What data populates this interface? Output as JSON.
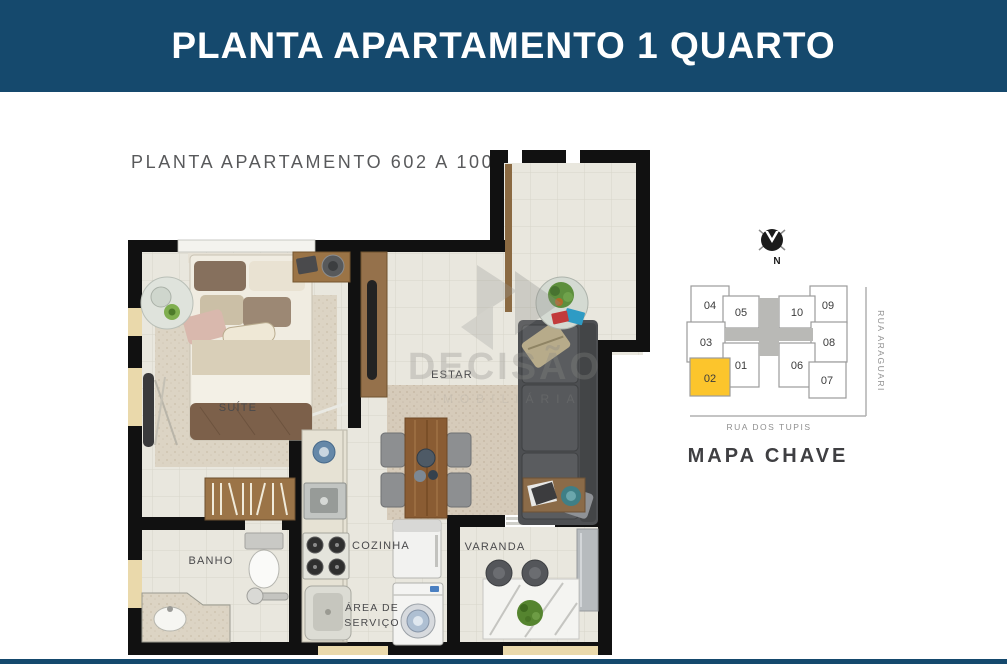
{
  "header": {
    "title": "PLANTA APARTAMENTO 1 QUARTO",
    "bg_color": "#15496d"
  },
  "plan": {
    "title": "PLANTA APARTAMENTO 602 A 1002",
    "rooms": {
      "suite": "SUÍTE",
      "estar": "ESTAR",
      "banho": "BANHO",
      "cozinha": "COZINHA",
      "area_servico_line1": "ÁREA DE",
      "area_servico_line2": "SERVIÇO",
      "varanda": "VARANDA"
    },
    "watermark": {
      "name": "DECISÃO",
      "subtitle": "IMOBILIÁRIA"
    }
  },
  "key_map": {
    "title": "MAPA CHAVE",
    "north_label": "N",
    "street_right": "RUA ARAGUARI",
    "street_bottom": "RUA DOS TUPIS",
    "highlight_color": "#fcc52c",
    "highlighted_unit": "02",
    "units": [
      {
        "label": "04"
      },
      {
        "label": "05"
      },
      {
        "label": "10"
      },
      {
        "label": "09"
      },
      {
        "label": "03"
      },
      {
        "label": "08"
      },
      {
        "label": "02"
      },
      {
        "label": "01"
      },
      {
        "label": "06"
      },
      {
        "label": "07"
      }
    ]
  }
}
